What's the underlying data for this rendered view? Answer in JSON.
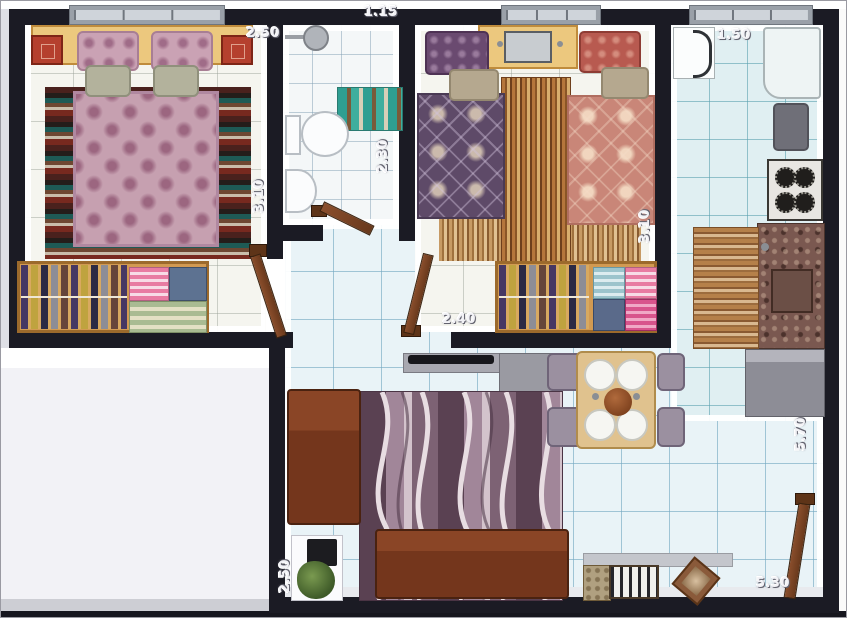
{
  "labels": {
    "bedroom1_width": "2.50",
    "bedroom1_depth": "3.10",
    "bathroom_width": "1.15",
    "bathroom_depth": "2.30",
    "bedroom2_depth": "3.10",
    "hall_width": "2.40",
    "kitchen_width": "1.50",
    "right_side_depth": "5.70",
    "living_left_depth": "2.50",
    "living_bottom_width": "5.30"
  },
  "colors": {
    "wall": "#1b1b24",
    "floor_tile": "#e9f3f7",
    "wood_accent": "#d29a52",
    "sofa_brown": "#74361c",
    "bed1_spread_pink": "#c6a0b0",
    "bed2_spread_purple": "#5e4a68",
    "bed2_spread_salmon": "#c98678",
    "bath_mat_teal": "#2f9e92"
  }
}
